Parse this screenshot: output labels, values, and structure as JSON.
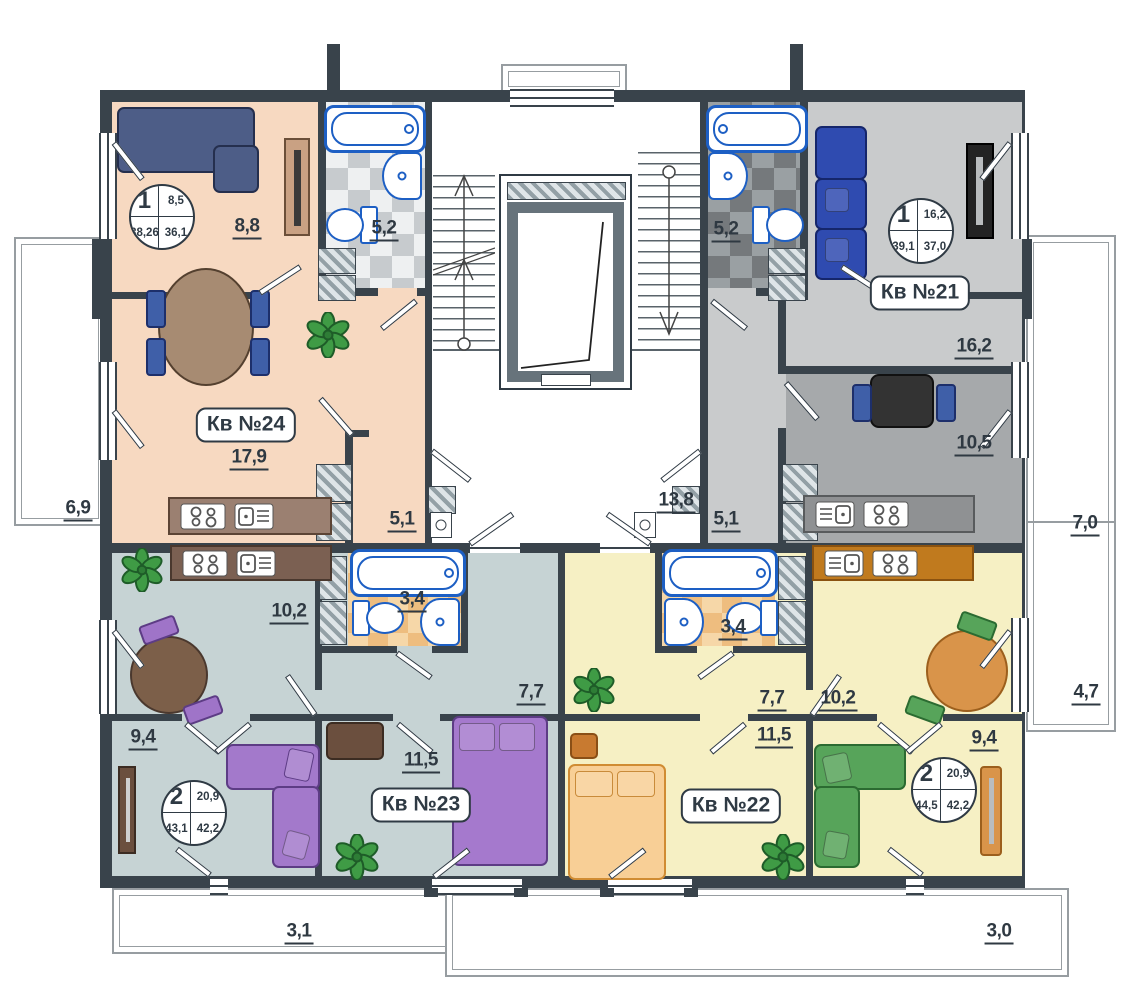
{
  "apartments": {
    "kv24": {
      "name": "Кв №24",
      "rooms": "1",
      "stamp": {
        "top_right": "8,5",
        "bottom_left": "38,26",
        "bottom_right": "36,1"
      },
      "room_areas": {
        "living": "8,8",
        "bath": "5,2",
        "kitchen_living": "17,9",
        "hall": "5,1"
      }
    },
    "kv21": {
      "name": "Кв №21",
      "rooms": "1",
      "stamp": {
        "top_right": "16,2",
        "bottom_left": "39,1",
        "bottom_right": "37,0"
      },
      "room_areas": {
        "bath": "5,2",
        "living": "16,2",
        "kitchen": "10,5",
        "hall": "5,1"
      }
    },
    "kv23": {
      "name": "Кв №23",
      "rooms": "2",
      "stamp": {
        "top_right": "20,9",
        "bottom_left": "43,1",
        "bottom_right": "42,2"
      },
      "room_areas": {
        "kitchen_living": "10,2",
        "bath": "3,4",
        "hall": "7,7",
        "bedroom_left": "9,4",
        "bedroom_right": "11,5"
      }
    },
    "kv22": {
      "name": "Кв №22",
      "rooms": "2",
      "stamp": {
        "top_right": "20,9",
        "bottom_left": "44,5",
        "bottom_right": "42,2"
      },
      "room_areas": {
        "kitchen_living": "10,2",
        "bath": "3,4",
        "hall": "7,7",
        "bedroom_left": "11,5",
        "bedroom_right": "9,4"
      }
    }
  },
  "common_areas": {
    "stair_corridor": "13,8"
  },
  "balconies": {
    "left": "6,9",
    "right_upper": "7,0",
    "right_lower": "4,7",
    "bottom_left": "3,1",
    "bottom_right": "3,0"
  },
  "colors": {
    "walls": "#39434b",
    "apt24": "#f7d9c1",
    "apt21": "#c9cbcc",
    "apt21_kitchen": "#a6a9ab",
    "apt23": "#c6d3d4",
    "apt22": "#f6f0c4",
    "plumbing": "#1d5fc4"
  }
}
